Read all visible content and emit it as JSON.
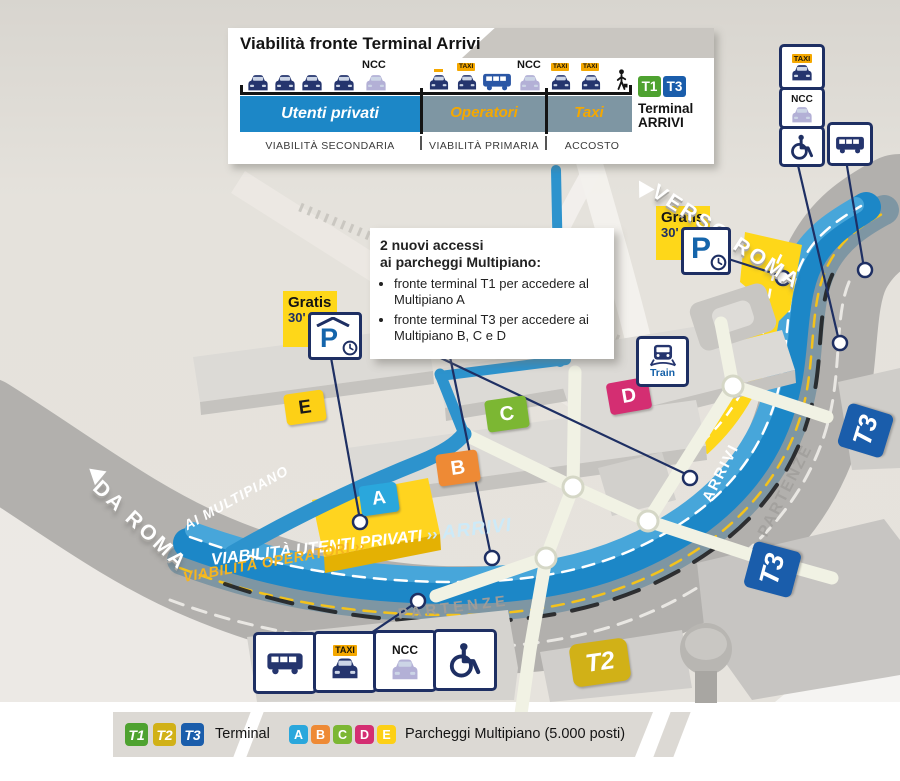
{
  "panel": {
    "title": "Viabilità fronte Terminal Arrivi",
    "ncc_private": "NCC",
    "ncc_operatori": "NCC",
    "taxi_sign": "TAXI",
    "lane_private_label": "Utenti privati",
    "lane_operatori_label": "Operatori",
    "lane_taxi_label": "Taxi",
    "caption_secondaria": "VIABILITÀ SECONDARIA",
    "caption_primaria": "VIABILITÀ PRIMARIA",
    "caption_accosto": "ACCOSTO",
    "badge_t1": "T1",
    "badge_t3": "T3",
    "terminal_word": "Terminal",
    "arrivi_word": "ARRIVI"
  },
  "info_box": {
    "title_line1": "2 nuovi accessi",
    "title_line2": "ai parcheggi Multipiano:",
    "bullet_1": "fronte terminal T1 per accedere al Multipiano A",
    "bullet_2": "fronte terminal T3 per accedere ai Multipiano B, C e D"
  },
  "signs": {
    "taxi": "TAXI",
    "ncc": "NCC",
    "train": "Train",
    "gratis": "Gratis",
    "gratis_time": "30'"
  },
  "roads": {
    "verso_roma": "VERSO ROMA",
    "da_roma": "DA ROMA",
    "ai_multipiano": "AI MULTIPIANO",
    "viabilita_utenti_privati": "VIABILITÀ UTENTI PRIVATI",
    "arrows_light": "››",
    "arrivi_main": "ARRIVI",
    "viabilita_operatori": "VIABILITÀ OPERATORI",
    "arrows_yellow": "››",
    "partenze_main": "PARTENZE",
    "arrivi_side": "ARRIVI",
    "partenze_side": "PARTENZE"
  },
  "parkings": {
    "a": {
      "label": "A",
      "color": "#2aa7dc"
    },
    "b": {
      "label": "B",
      "color": "#ee8a35"
    },
    "c": {
      "label": "C",
      "color": "#7cb733"
    },
    "d": {
      "label": "D",
      "color": "#d42e72"
    },
    "e": {
      "label": "E",
      "color": "#fdd016"
    }
  },
  "terminals": {
    "t1": {
      "label": "T1",
      "color": "#4ea230"
    },
    "t2": {
      "label": "T2",
      "color": "#d1b117"
    },
    "t3": {
      "label": "T3",
      "color": "#1a5dab"
    }
  },
  "bottom_legend": {
    "terminal_caption": "Terminal",
    "parking_caption": "Parcheggi Multipiano (5.000 posti)"
  },
  "colors": {
    "navy": "#1e2f63",
    "road_blue": "#1c87c7",
    "road_blue_light": "#47a6da",
    "road_operatori": "#7e96a3",
    "road_gray": "#b2b0ad",
    "zone_yellow": "#fed719",
    "text_orange": "#f5a800"
  }
}
